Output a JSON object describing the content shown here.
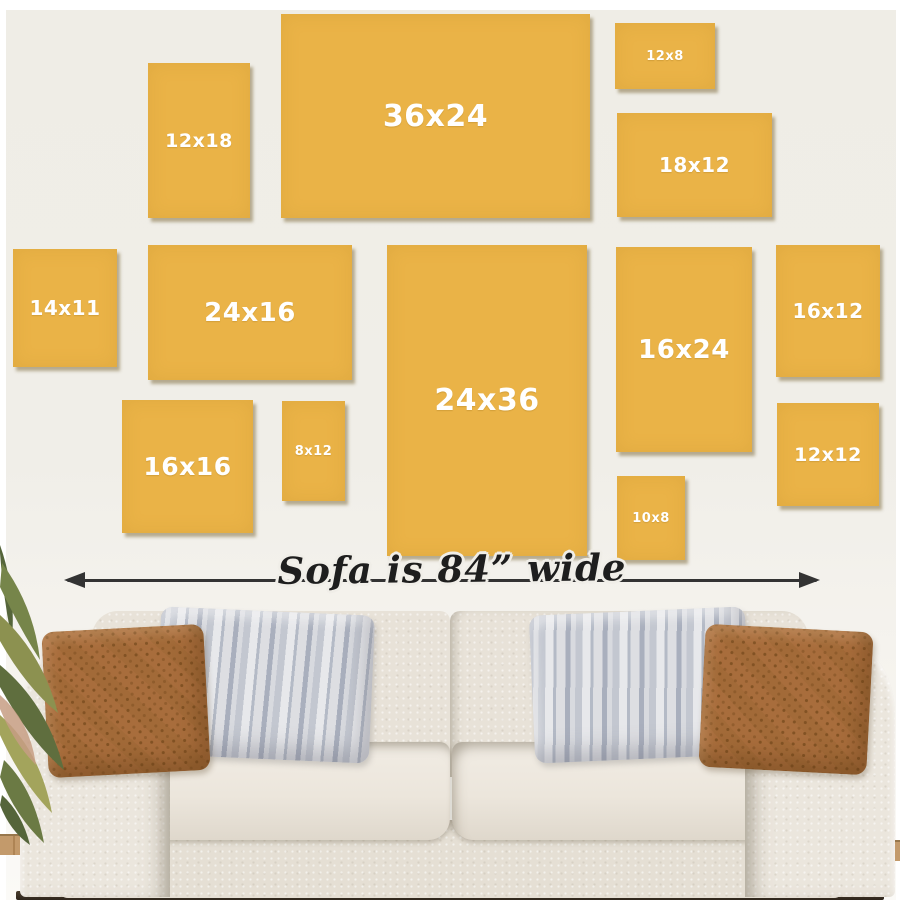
{
  "caption": {
    "text": "Sofa is 84” wide"
  },
  "frames": [
    {
      "label": "12x18",
      "x": 148,
      "y": 63,
      "w": 102,
      "h": 155
    },
    {
      "label": "36x24",
      "x": 281,
      "y": 14,
      "w": 309,
      "h": 204
    },
    {
      "label": "12x8",
      "x": 615,
      "y": 23,
      "w": 100,
      "h": 66
    },
    {
      "label": "18x12",
      "x": 617,
      "y": 113,
      "w": 155,
      "h": 104
    },
    {
      "label": "14x11",
      "x": 13,
      "y": 249,
      "w": 104,
      "h": 118
    },
    {
      "label": "24x16",
      "x": 148,
      "y": 245,
      "w": 204,
      "h": 135
    },
    {
      "label": "24x36",
      "x": 387,
      "y": 245,
      "w": 200,
      "h": 311
    },
    {
      "label": "16x24",
      "x": 616,
      "y": 247,
      "w": 136,
      "h": 205
    },
    {
      "label": "16x12",
      "x": 776,
      "y": 245,
      "w": 104,
      "h": 132
    },
    {
      "label": "16x16",
      "x": 122,
      "y": 400,
      "w": 131,
      "h": 133
    },
    {
      "label": "8x12",
      "x": 282,
      "y": 401,
      "w": 63,
      "h": 100
    },
    {
      "label": "10x8",
      "x": 617,
      "y": 476,
      "w": 68,
      "h": 84
    },
    {
      "label": "12x12",
      "x": 777,
      "y": 403,
      "w": 102,
      "h": 103
    }
  ],
  "colors": {
    "wall": "#F0EEE8",
    "border": "#FFFFFF",
    "frame": "#EAB347",
    "frame_text": "#FFFFFF",
    "arrow": "#333333",
    "caption_text": "#1E1E1E",
    "pillow_rust": "#A86D3C",
    "pillow_gray": "#CDD0D6",
    "floor_wood": "#C39A6B",
    "floor_line": "#2E261C"
  }
}
